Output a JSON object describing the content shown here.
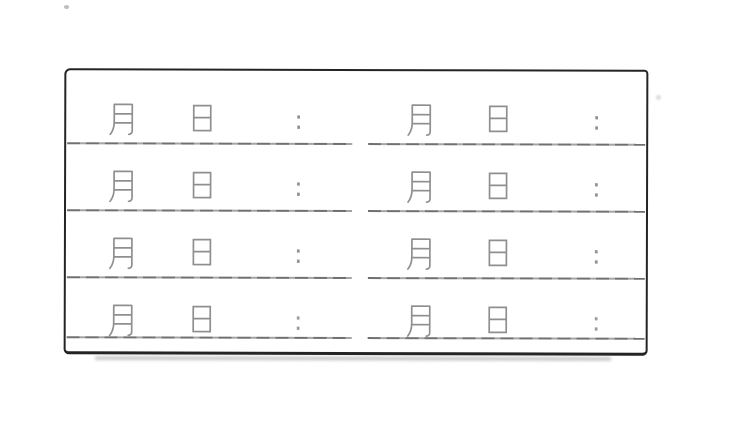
{
  "page": {
    "background_color": "#ffffff"
  },
  "sheet": {
    "description": "Blank scanned date and time entry grid",
    "border_color": "#242424",
    "line_color": "#7e7e7e",
    "glyph_color": "#8f8f8f",
    "row_count": 4,
    "column_count": 2,
    "rows": [
      {
        "cells": [
          {
            "month": "月",
            "day": "日",
            "separator": ":"
          },
          {
            "month": "月",
            "day": "日",
            "separator": ":"
          }
        ]
      },
      {
        "cells": [
          {
            "month": "月",
            "day": "日",
            "separator": ":"
          },
          {
            "month": "月",
            "day": "日",
            "separator": ":"
          }
        ]
      },
      {
        "cells": [
          {
            "month": "月",
            "day": "日",
            "separator": ":"
          },
          {
            "month": "月",
            "day": "日",
            "separator": ":"
          }
        ]
      },
      {
        "cells": [
          {
            "month": "月",
            "day": "日",
            "separator": ":"
          },
          {
            "month": "月",
            "day": "日",
            "separator": ":"
          }
        ]
      }
    ]
  }
}
